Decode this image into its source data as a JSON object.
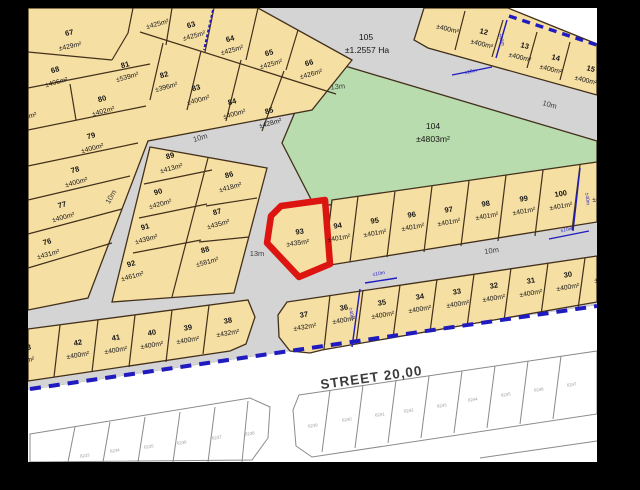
{
  "colors": {
    "plot_fill": "#f6dfa3",
    "green_fill": "#b8dcae",
    "road_gray": "#d4d4d4",
    "boundary_blue": "#1f1bbf",
    "highlight_red": "#dd1510",
    "frame_black": "#000000"
  },
  "highlight": {
    "n": "93",
    "a": "±435m²"
  },
  "street": {
    "label": "STREET 20,00"
  },
  "roads": {
    "w10": "10m",
    "w13": "13m"
  },
  "dims": {
    "d10": "±10m",
    "d40": "±40m"
  },
  "areas": {
    "p104": {
      "n": "104",
      "a": "±4803m²"
    },
    "p105": {
      "n": "105",
      "a": "±1.2557 Ha"
    }
  },
  "plots": {
    "p62": {
      "a": "±425m²"
    },
    "p63": {
      "n": "63",
      "a": "±425m²"
    },
    "p64": {
      "n": "64",
      "a": "±425m²"
    },
    "p65": {
      "n": "65",
      "a": "±425m²"
    },
    "p66": {
      "n": "66",
      "a": "±426m²"
    },
    "p67": {
      "n": "67",
      "a": "±429m²"
    },
    "p68": {
      "n": "68",
      "a": "±406m²"
    },
    "p69": {
      "n": "69",
      "a": "±406m²"
    },
    "p75": {
      "a": "±400m²"
    },
    "p76": {
      "n": "76",
      "a": "±431m²"
    },
    "p77": {
      "n": "77",
      "a": "±400m²"
    },
    "p78": {
      "n": "78",
      "a": "±400m²"
    },
    "p79": {
      "n": "79",
      "a": "±400m²"
    },
    "p80": {
      "n": "80",
      "a": "±402m²"
    },
    "p81": {
      "n": "81",
      "a": "±539m²"
    },
    "p82": {
      "n": "82",
      "a": "±396m²"
    },
    "p83": {
      "n": "83",
      "a": "±400m²"
    },
    "p84": {
      "n": "84",
      "a": "±400m²"
    },
    "p85": {
      "n": "85",
      "a": "±428m²"
    },
    "p86": {
      "n": "86",
      "a": "±418m²"
    },
    "p87": {
      "n": "87",
      "a": "±435m²"
    },
    "p88": {
      "n": "88",
      "a": "±581m²"
    },
    "p89": {
      "n": "89",
      "a": "±413m²"
    },
    "p90": {
      "n": "90",
      "a": "±420m²"
    },
    "p91": {
      "n": "91",
      "a": "±439m²"
    },
    "p92": {
      "n": "92",
      "a": "±461m²"
    },
    "p11": {
      "a": "±400m²"
    },
    "p12": {
      "n": "12",
      "a": "±400m²"
    },
    "p13": {
      "n": "13",
      "a": "±400m²"
    },
    "p14": {
      "n": "14",
      "a": "±400m²"
    },
    "p15": {
      "n": "15",
      "a": "±400m²"
    },
    "p94": {
      "n": "94",
      "a": "±401m²"
    },
    "p95": {
      "n": "95",
      "a": "±401m²"
    },
    "p96": {
      "n": "96",
      "a": "±401m²"
    },
    "p97": {
      "n": "97",
      "a": "±401m²"
    },
    "p98": {
      "n": "98",
      "a": "±401m²"
    },
    "p99": {
      "n": "99",
      "a": "±401m²"
    },
    "p100": {
      "n": "100",
      "a": "±401m²"
    },
    "p100e": {
      "a": "±401m²"
    },
    "p30": {
      "n": "30",
      "a": "±400m²"
    },
    "p30e": {
      "a": "±400m²"
    },
    "p31": {
      "n": "31",
      "a": "±400m²"
    },
    "p32": {
      "n": "32",
      "a": "±400m²"
    },
    "p33": {
      "n": "33",
      "a": "±400m²"
    },
    "p34": {
      "n": "34",
      "a": "±400m²"
    },
    "p35": {
      "n": "35",
      "a": "±400m²"
    },
    "p36": {
      "n": "36",
      "a": "±400m²"
    },
    "p37": {
      "n": "37",
      "a": "±432m²"
    },
    "p38": {
      "n": "38",
      "a": "±432m²"
    },
    "p39": {
      "n": "39",
      "a": "±400m²"
    },
    "p40": {
      "n": "40",
      "a": "±400m²"
    },
    "p41": {
      "n": "41",
      "a": "±400m²"
    },
    "p42": {
      "n": "42",
      "a": "±400m²"
    },
    "p43": {
      "n": "43",
      "a": "±400m²"
    }
  },
  "white_lots": {
    "n6233": "6233",
    "n6234": "6234",
    "n6235": "6235",
    "n6236": "6236",
    "n6237": "6237",
    "n6238": "6238",
    "n6239": "6239",
    "n6240": "6240",
    "n6241": "6241",
    "n6242": "6242",
    "n6243": "6243",
    "n6244": "6244",
    "n6245": "6245",
    "n6246": "6246",
    "n6247": "6247"
  }
}
